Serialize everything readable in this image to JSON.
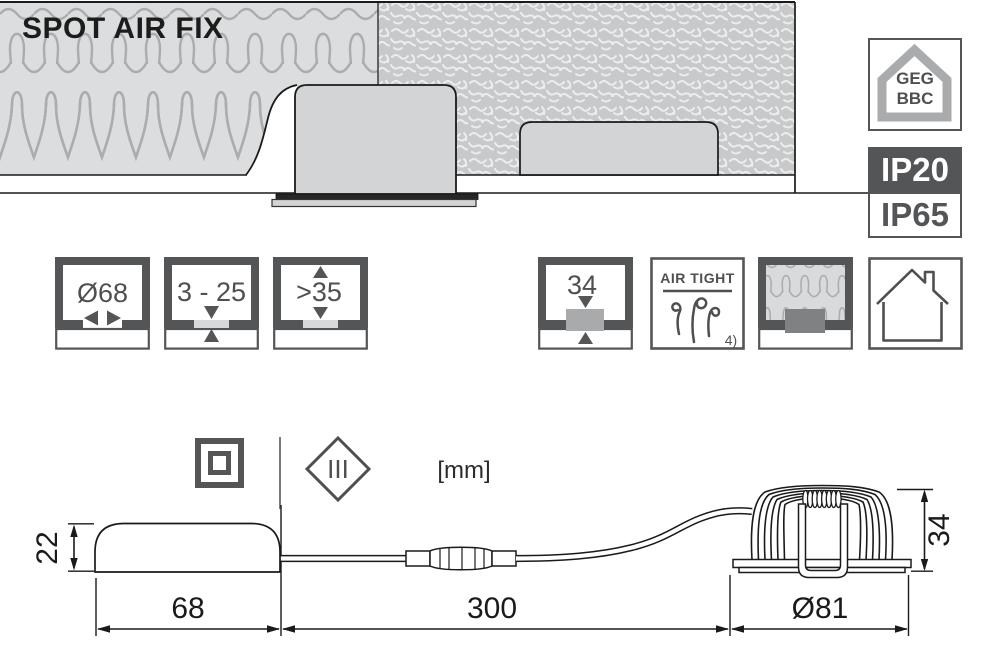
{
  "title": "SPOT AIR FIX",
  "badges": {
    "geg": {
      "line1": "GEG",
      "line2": "BBC"
    },
    "ip_above_ceiling": "IP20",
    "ip_below_ceiling": "IP65"
  },
  "spec_icons": {
    "cutout_diameter": "Ø68",
    "ceiling_thickness": "3 - 25",
    "recess_depth": ">35",
    "height_above_ceiling": "34",
    "airtight": {
      "label": "AIR TIGHT",
      "footnote": "4)"
    }
  },
  "class_row": {
    "protection_class": "III",
    "unit": "[mm]"
  },
  "dimensions": {
    "driver_height": "22",
    "driver_width": "68",
    "cable_length": "300",
    "spot_diameter": "Ø81",
    "spot_height": "34"
  },
  "colors": {
    "dark_gray": "#545557",
    "light_gray": "#d2d4d5",
    "outline": "#1a1a1a",
    "insulation_bg": "#dcddde",
    "insulation_stroke": "#aaacae",
    "blown_insulation_bg": "#c8c9cb",
    "badge_ip20_bg": "#545557"
  }
}
